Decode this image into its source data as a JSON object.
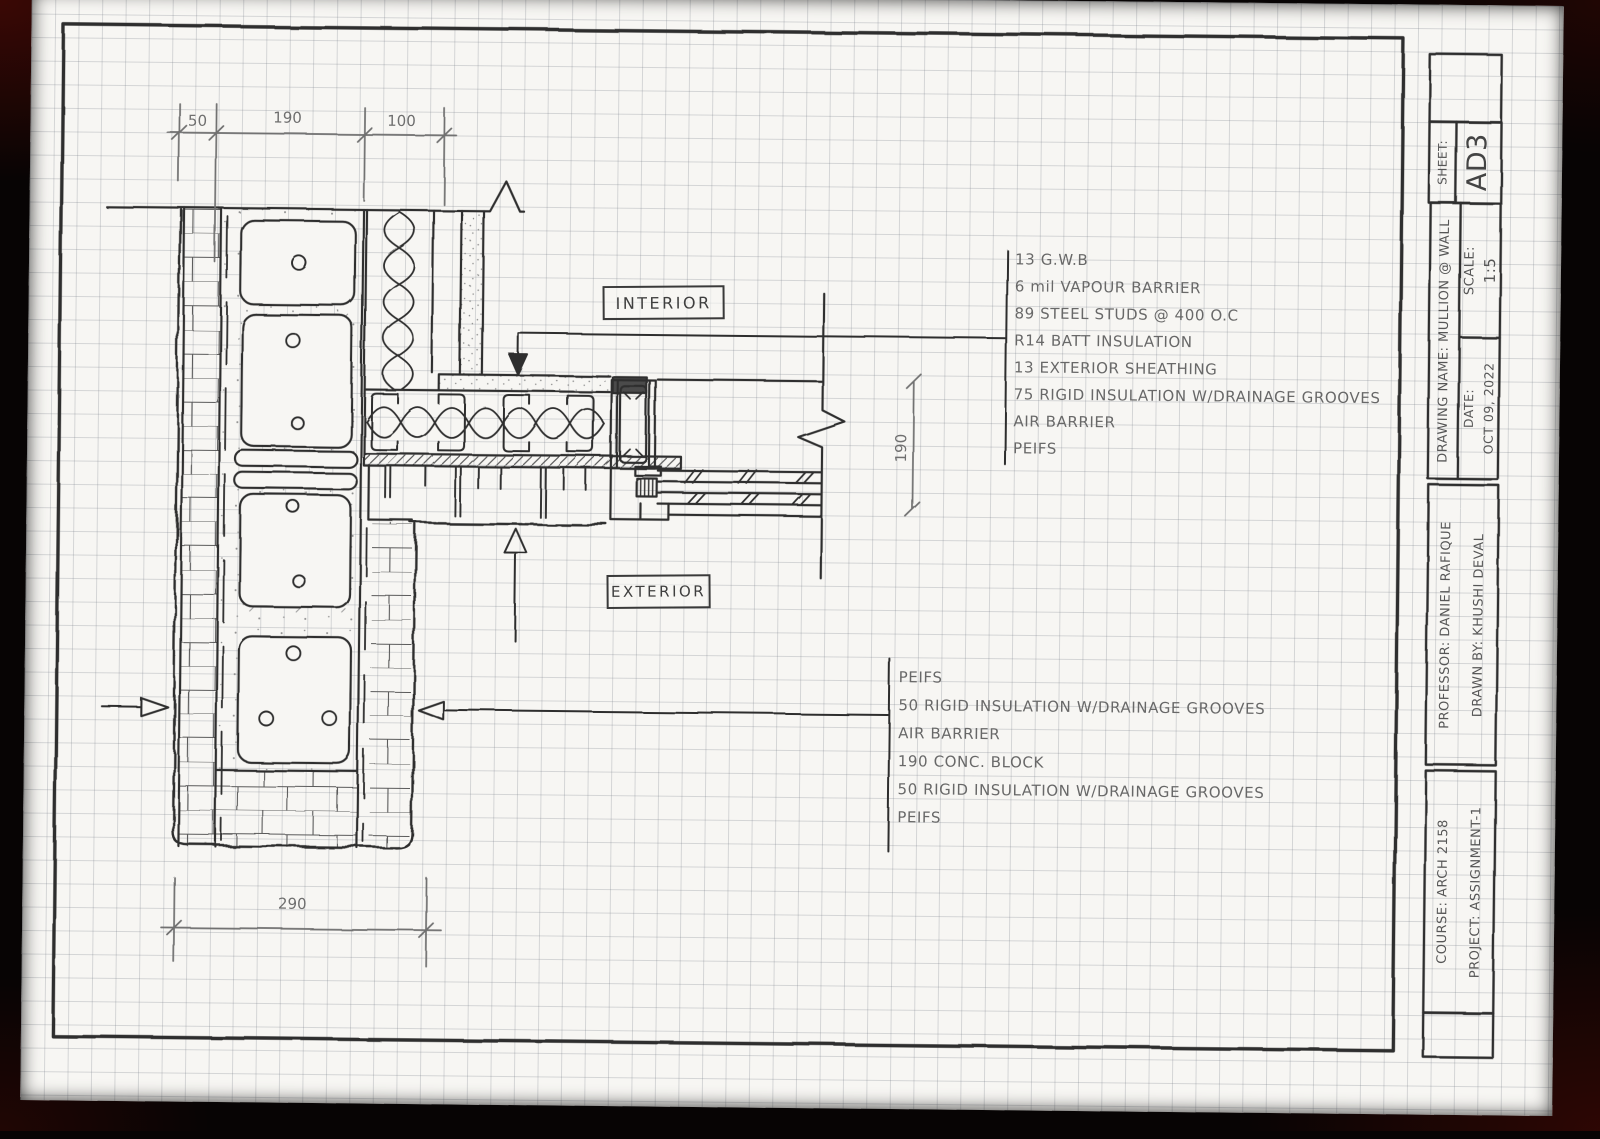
{
  "drawing": {
    "interior_label": "INTERIOR",
    "exterior_label": "EXTERIOR"
  },
  "dimensions": {
    "top_left": "50",
    "top_mid": "190",
    "top_right": "100",
    "bottom": "290",
    "right": "190"
  },
  "annotations": {
    "upper": {
      "lines": [
        "13 G.W.B",
        "6 mil VAPOUR BARRIER",
        "89 STEEL STUDS @ 400 O.C",
        "R14 BATT INSULATION",
        "13 EXTERIOR SHEATHING",
        "75 RIGID INSULATION W/DRAINAGE GROOVES",
        "AIR BARRIER",
        "PEIFS"
      ]
    },
    "lower": {
      "lines": [
        "PEIFS",
        "50 RIGID INSULATION W/DRAINAGE GROOVES",
        "AIR BARRIER",
        "190 CONC. BLOCK",
        "50 RIGID INSULATION W/DRAINAGE GROOVES",
        "PEIFS"
      ]
    }
  },
  "title_block": {
    "sheet_label": "SHEET:",
    "sheet_value": "AD3",
    "drawing_name": "DRAWING NAME: MULLION @ WALL",
    "scale_label": "SCALE:",
    "scale_value": "1:5",
    "date_label": "DATE:",
    "date_value": "OCT 09, 2022",
    "professor": "PROFESSOR: DANIEL RAFIQUE",
    "drawn_by": "DRAWN BY: KHUSHI DEVAL",
    "course": "COURSE: ARCH 2158",
    "project": "PROJECT: ASSIGNMENT-1"
  },
  "colors": {
    "ink": "#2f2f2f",
    "pencil": "#6f6f6f",
    "paper": "#f7f6f3",
    "background": "#070404"
  }
}
